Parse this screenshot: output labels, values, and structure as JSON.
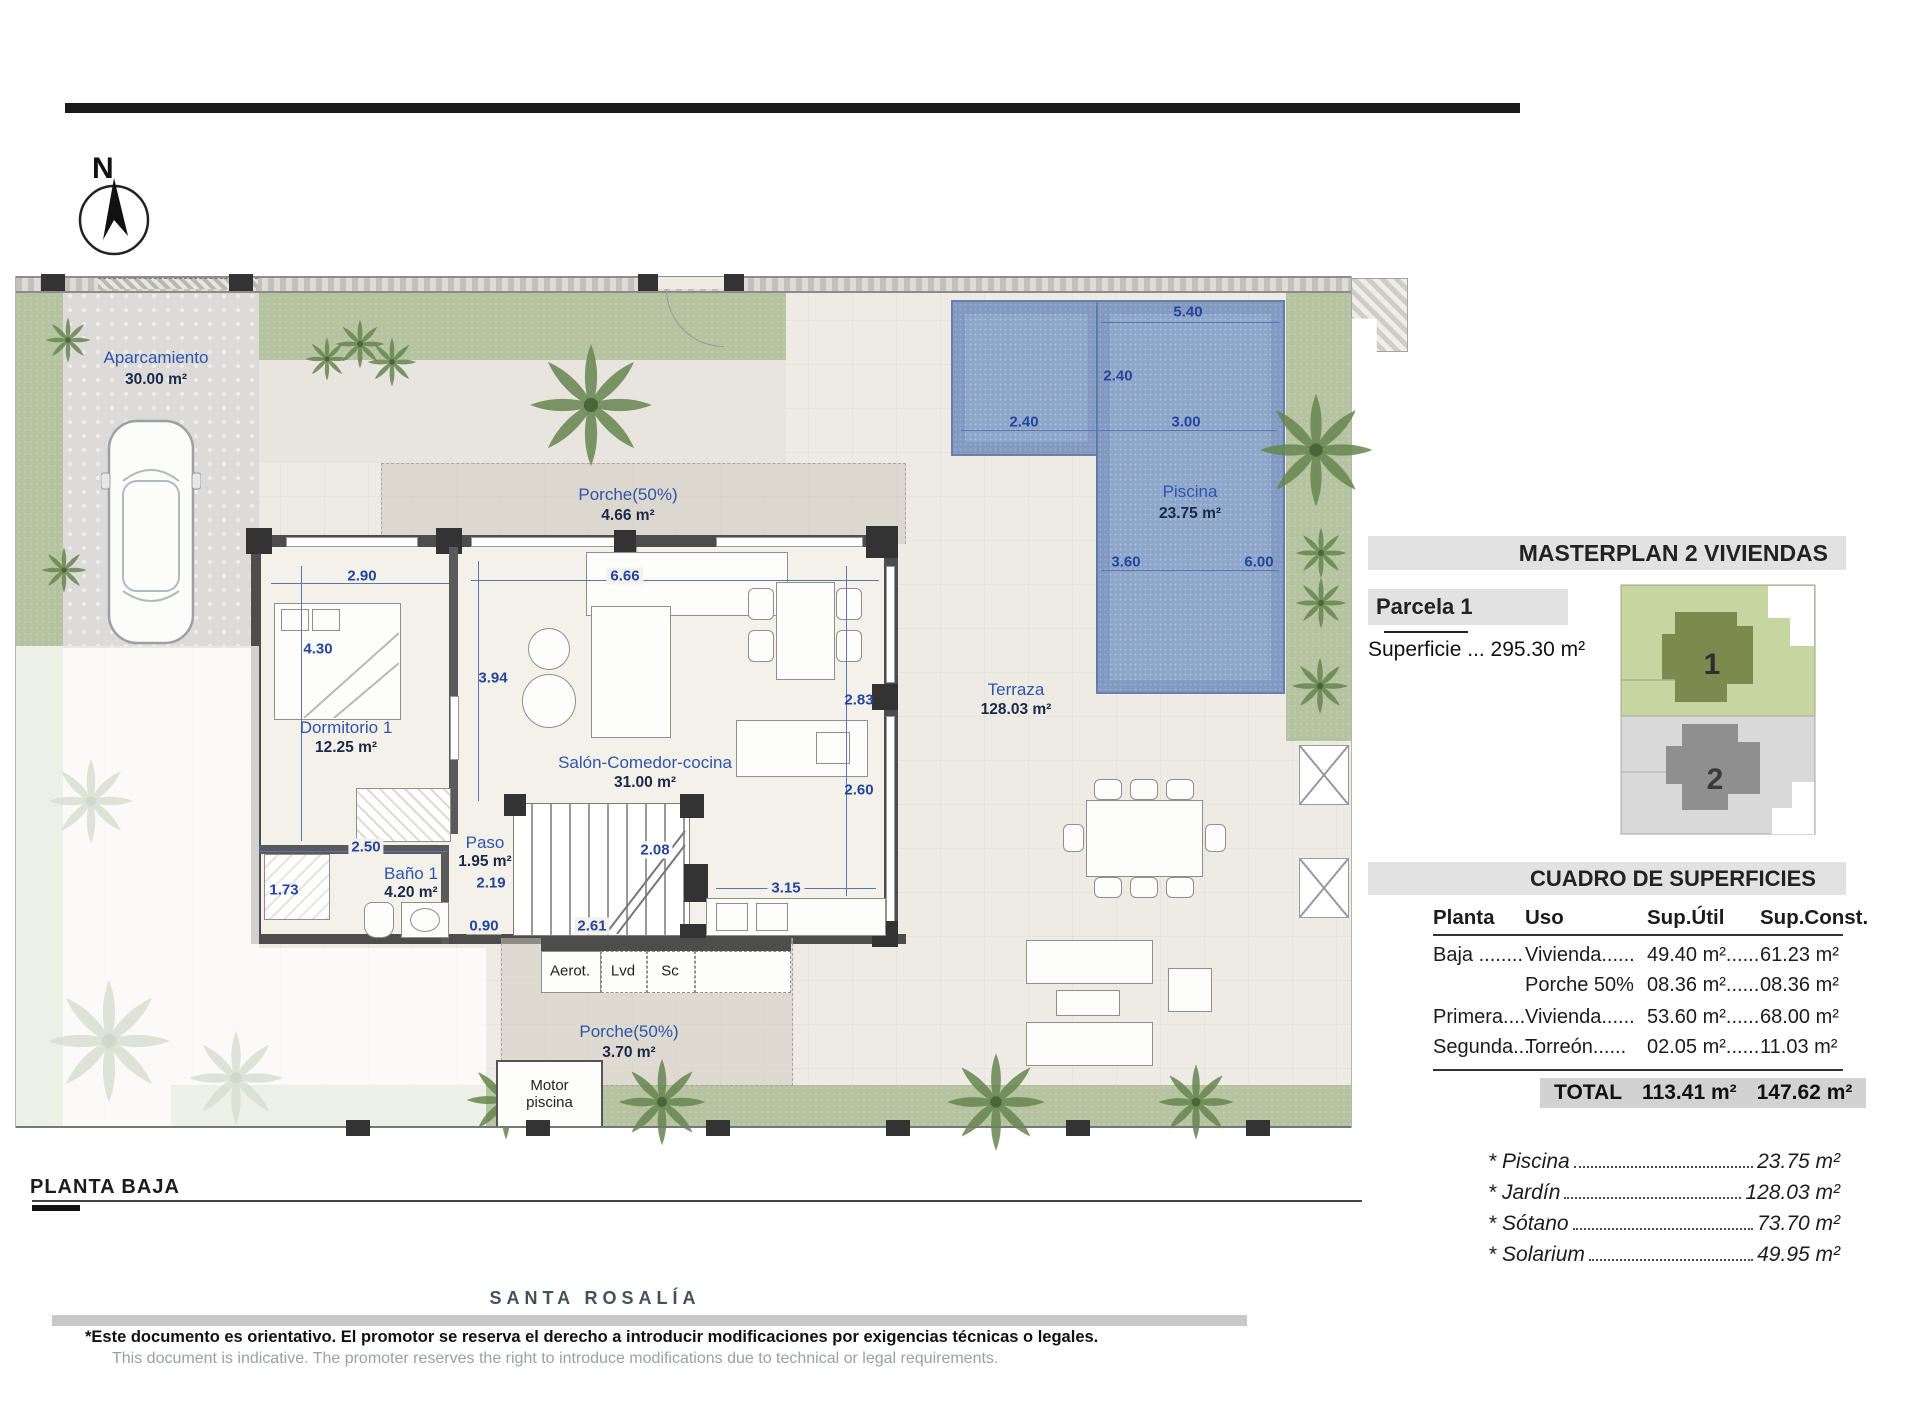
{
  "compass": {
    "north": "N"
  },
  "plan": {
    "aparcamiento": {
      "name": "Aparcamiento",
      "area": "30.00 m²"
    },
    "porche_top": {
      "name": "Porche(50%)",
      "area": "4.66 m²"
    },
    "dormitorio": {
      "name": "Dormitorio 1",
      "area": "12.25 m²"
    },
    "salon": {
      "name": "Salón-Comedor-cocina",
      "area": "31.00 m²"
    },
    "paso": {
      "name": "Paso",
      "area": "1.95 m²"
    },
    "bano": {
      "name": "Baño 1",
      "area": "4.20 m²"
    },
    "terraza": {
      "name": "Terraza",
      "area": "128.03 m²"
    },
    "piscina": {
      "name": "Piscina",
      "area": "23.75 m²"
    },
    "porche_bottom": {
      "name": "Porche(50%)",
      "area": "3.70 m²"
    },
    "motor_piscina": {
      "line1": "Motor",
      "line2": "piscina"
    },
    "utility": {
      "aerot": "Aerot.",
      "lvd": "Lvd",
      "sc": "Sc"
    },
    "dims": {
      "bedroom_w": "2.90",
      "bedroom_h": "4.30",
      "salon_left_h": "3.94",
      "salon_w": "6.66",
      "salon_right_h": "2.83",
      "salon_right_h2": "2.60",
      "paso_w": "2.50",
      "bath_h": "1.73",
      "paso_h": "2.19",
      "stairs_d": "2.08",
      "kitchen_w": "3.15",
      "bottom_left": "0.90",
      "bottom_right": "2.61",
      "pool_top": "5.40",
      "pool_v": "2.40",
      "pool_arm": "2.40",
      "pool_mid": "3.00",
      "pool_bl": "3.60",
      "pool_br": "6.00"
    }
  },
  "masterplan": {
    "title": "MASTERPLAN 2 VIVIENDAS",
    "parcela": "Parcela 1",
    "superficie": "Superficie ... 295.30 m²",
    "unit1": "1",
    "unit2": "2"
  },
  "cuadro": {
    "title": "CUADRO DE SUPERFICIES",
    "headers": [
      "Planta",
      "Uso",
      "Sup.Útil",
      "Sup.Const."
    ],
    "rows": [
      [
        "Baja ........",
        "Vivienda......",
        "49.40 m²......",
        "61.23 m²"
      ],
      [
        "",
        "Porche 50%",
        "08.36 m²......",
        "08.36 m²"
      ],
      [
        "Primera....",
        "Vivienda......",
        "53.60 m²......",
        "68.00 m²"
      ],
      [
        "Segunda...",
        "Torreón......",
        "02.05 m²......",
        "11.03 m²"
      ]
    ],
    "total_label": "TOTAL",
    "total_util": "113.41 m²",
    "total_const": "147.62 m²"
  },
  "extras": [
    {
      "label": "* Piscina",
      "value": "23.75 m²"
    },
    {
      "label": "* Jardín",
      "value": "128.03 m²"
    },
    {
      "label": "* Sótano",
      "value": "73.70 m²"
    },
    {
      "label": "* Solarium",
      "value": "49.95 m²"
    }
  ],
  "footer": {
    "plan_label": "PLANTA BAJA",
    "brand": "SANTA ROSALÍA",
    "disclaimer_es": "*Este documento es orientativo. El promotor se reserva el derecho a introducir modificaciones por exigencias técnicas o legales.",
    "disclaimer_en": "This document is indicative. The promoter reserves the right to introduce modifications due to technical or legal requirements."
  }
}
